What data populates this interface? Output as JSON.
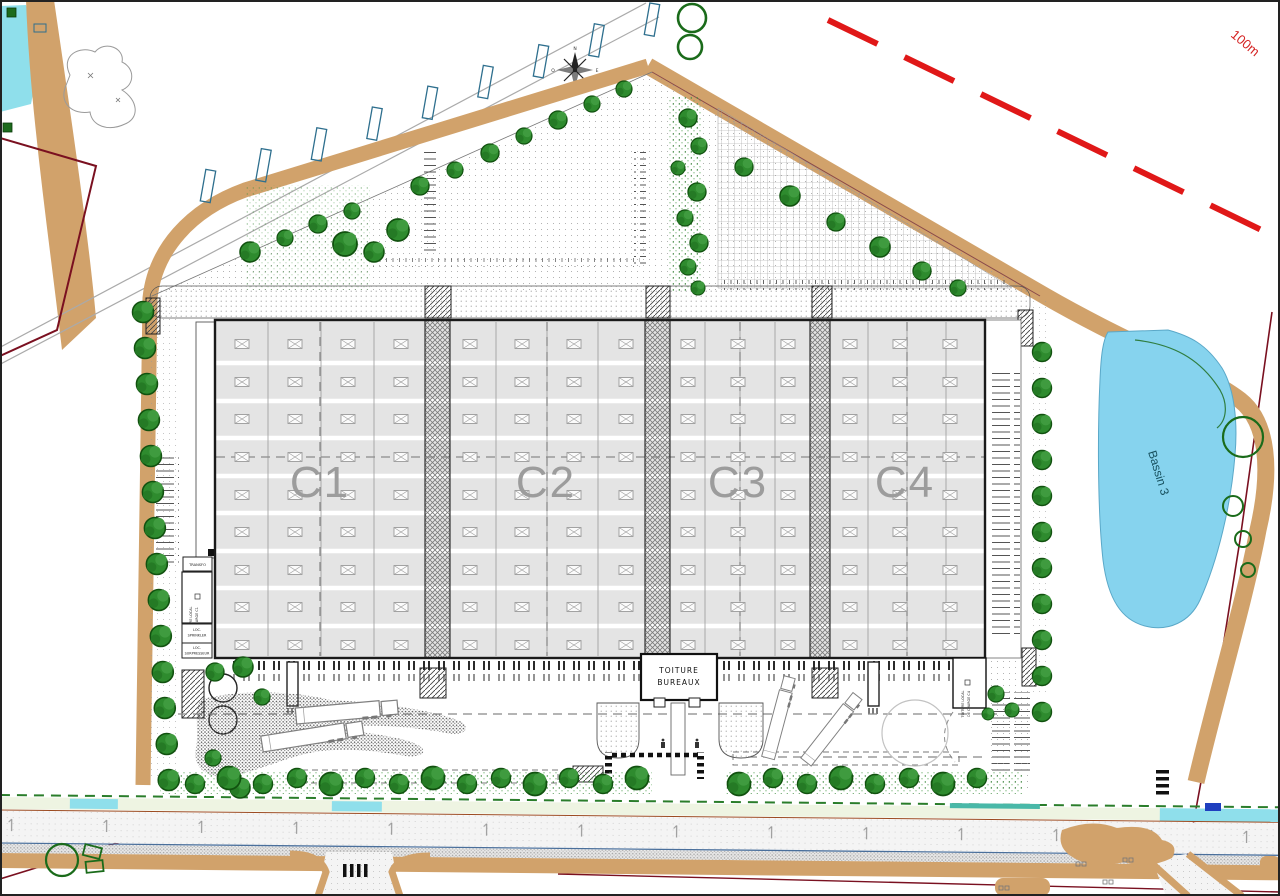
{
  "plan": {
    "building_cells": [
      {
        "label": "C1"
      },
      {
        "label": "C2"
      },
      {
        "label": "C3"
      },
      {
        "label": "C4"
      }
    ],
    "office": {
      "line1": "TOITURE",
      "line2": "BUREAUX"
    },
    "tech": {
      "transfo": "TRANSFO",
      "charge_c1_l1": "TOITURE LOCAL",
      "charge_c1_l2": "DE CHARGE C1",
      "sprinkler_l1": "LOC.",
      "sprinkler_l2": "SPRINKLER",
      "surpresseur_l1": "LOC.",
      "surpresseur_l2": "SURPRESSEUR",
      "charge_c4_l1": "TOITURE LOCAL",
      "charge_c4_l2": "DE CHARGE C4"
    },
    "basin_label": "Bassin 3",
    "distance_marker": "100m",
    "compass": {
      "n": "N",
      "s": "S",
      "e": "E",
      "o": "O"
    },
    "colors": {
      "berm_tan": "#d1a26b",
      "water_blue": "#86d3ee",
      "tree_green": "#2e8b2e",
      "parcel_boundary_red": "#7a1020",
      "marker_red": "#e01818",
      "roof_gray": "#e4e4e4",
      "cell_label_gray": "#9c9c9c"
    }
  }
}
